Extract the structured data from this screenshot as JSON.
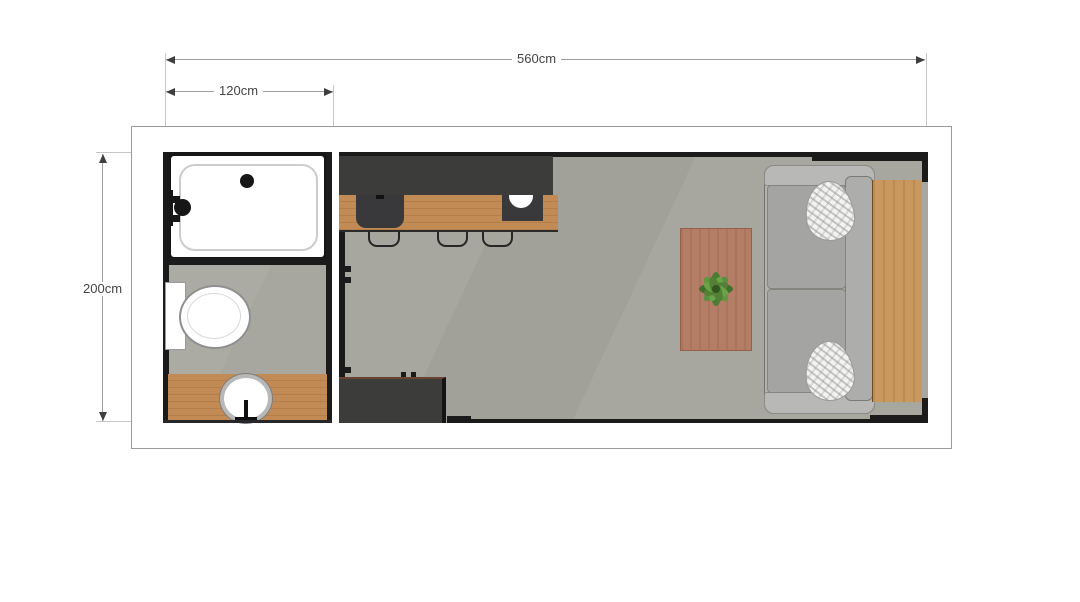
{
  "floorplan": {
    "type": "apartment-floor-plan-top-view",
    "dimensions": [
      {
        "id": "total_width",
        "label": "560cm"
      },
      {
        "id": "bathroom_width",
        "label": "120cm"
      },
      {
        "id": "depth",
        "label": "200cm"
      }
    ],
    "rooms": [
      {
        "name": "bathroom",
        "fixtures": [
          "bathtub",
          "tub-faucet",
          "tub-drain",
          "toilet",
          "vanity-counter",
          "round-sink",
          "sink-faucet"
        ]
      },
      {
        "name": "main-room",
        "fixtures": [
          "kitchen-upper-unit",
          "kitchen-counter",
          "kitchen-sink",
          "cooktop-unit",
          "cooktop-bowl",
          "bar-stool",
          "bar-stool",
          "bar-stool",
          "storage-unit",
          "coffee-table",
          "potted-plant",
          "sofa",
          "sofa-pillow",
          "sofa-pillow",
          "wood-platform"
        ]
      }
    ],
    "colors": {
      "floor": "#a7a79f",
      "interior_wall": "#1b1b1b",
      "kitchen_dark": "#3c3c3a",
      "counter_wood": "#c28a54",
      "platform_wood": "#c9985e",
      "table_wood": "#b47e66",
      "sofa_gray": "#a9a9a7",
      "pillow_white": "#f3f3f1",
      "plant_green": "#54853c",
      "outer_wall": "#ffffff",
      "annotation_text": "#454545"
    }
  }
}
